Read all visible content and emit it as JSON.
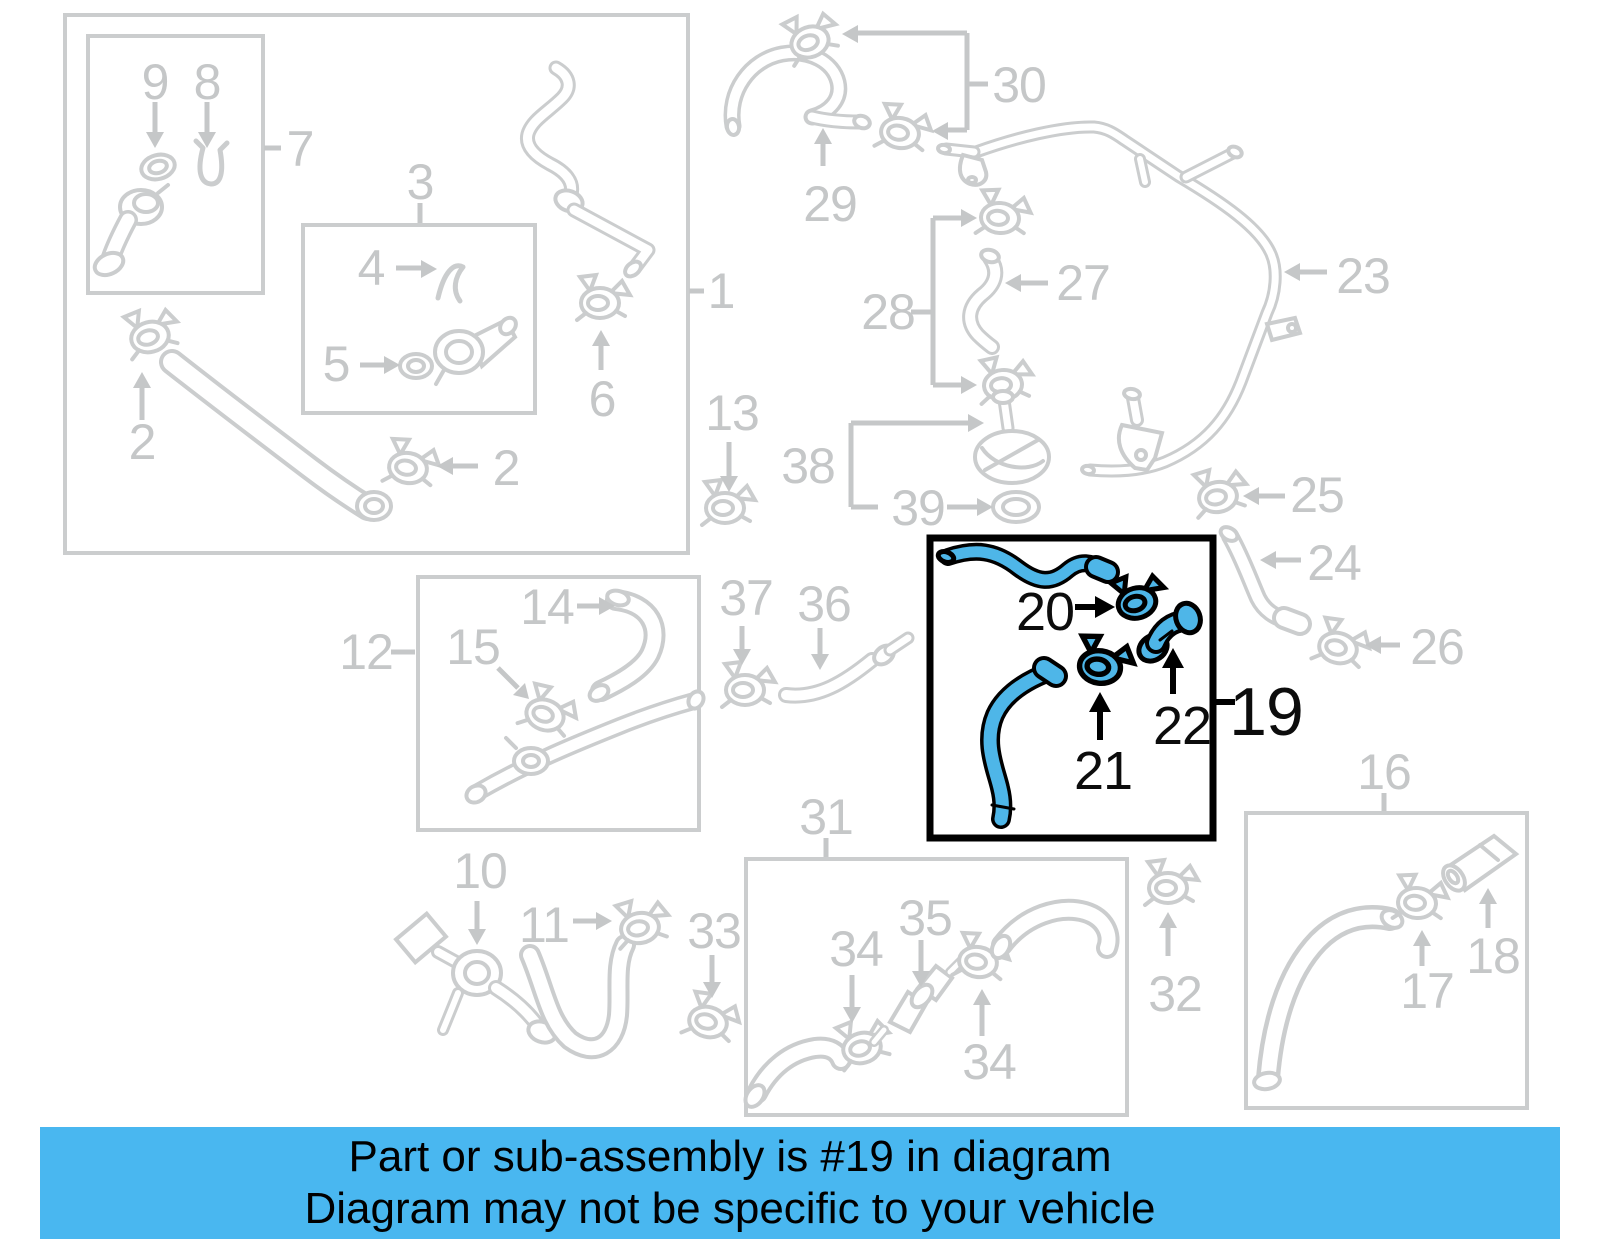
{
  "diagram_labels": {
    "n1": "1",
    "n2": "2",
    "n3": "3",
    "n4": "4",
    "n5": "5",
    "n6": "6",
    "n7": "7",
    "n8": "8",
    "n9": "9",
    "n10": "10",
    "n11": "11",
    "n12": "12",
    "n13": "13",
    "n14": "14",
    "n15": "15",
    "n16": "16",
    "n17": "17",
    "n18": "18",
    "n19": "19",
    "n20": "20",
    "n21": "21",
    "n22": "22",
    "n23": "23",
    "n24": "24",
    "n25": "25",
    "n26": "26",
    "n27": "27",
    "n28": "28",
    "n29": "29",
    "n30": "30",
    "n31": "31",
    "n32": "32",
    "n33": "33",
    "n34": "34",
    "n35": "35",
    "n36": "36",
    "n37": "37",
    "n38": "38",
    "n39": "39"
  },
  "highlight": {
    "part_number": "19",
    "sub_parts": [
      "20",
      "21",
      "22"
    ],
    "part_color": "#4eb6e8",
    "line_gray": "#cbcdce"
  },
  "banner": {
    "line1": "Part or sub-assembly is #19 in diagram",
    "line2": "Diagram may not be specific to your vehicle",
    "background": "#49b7f0"
  }
}
